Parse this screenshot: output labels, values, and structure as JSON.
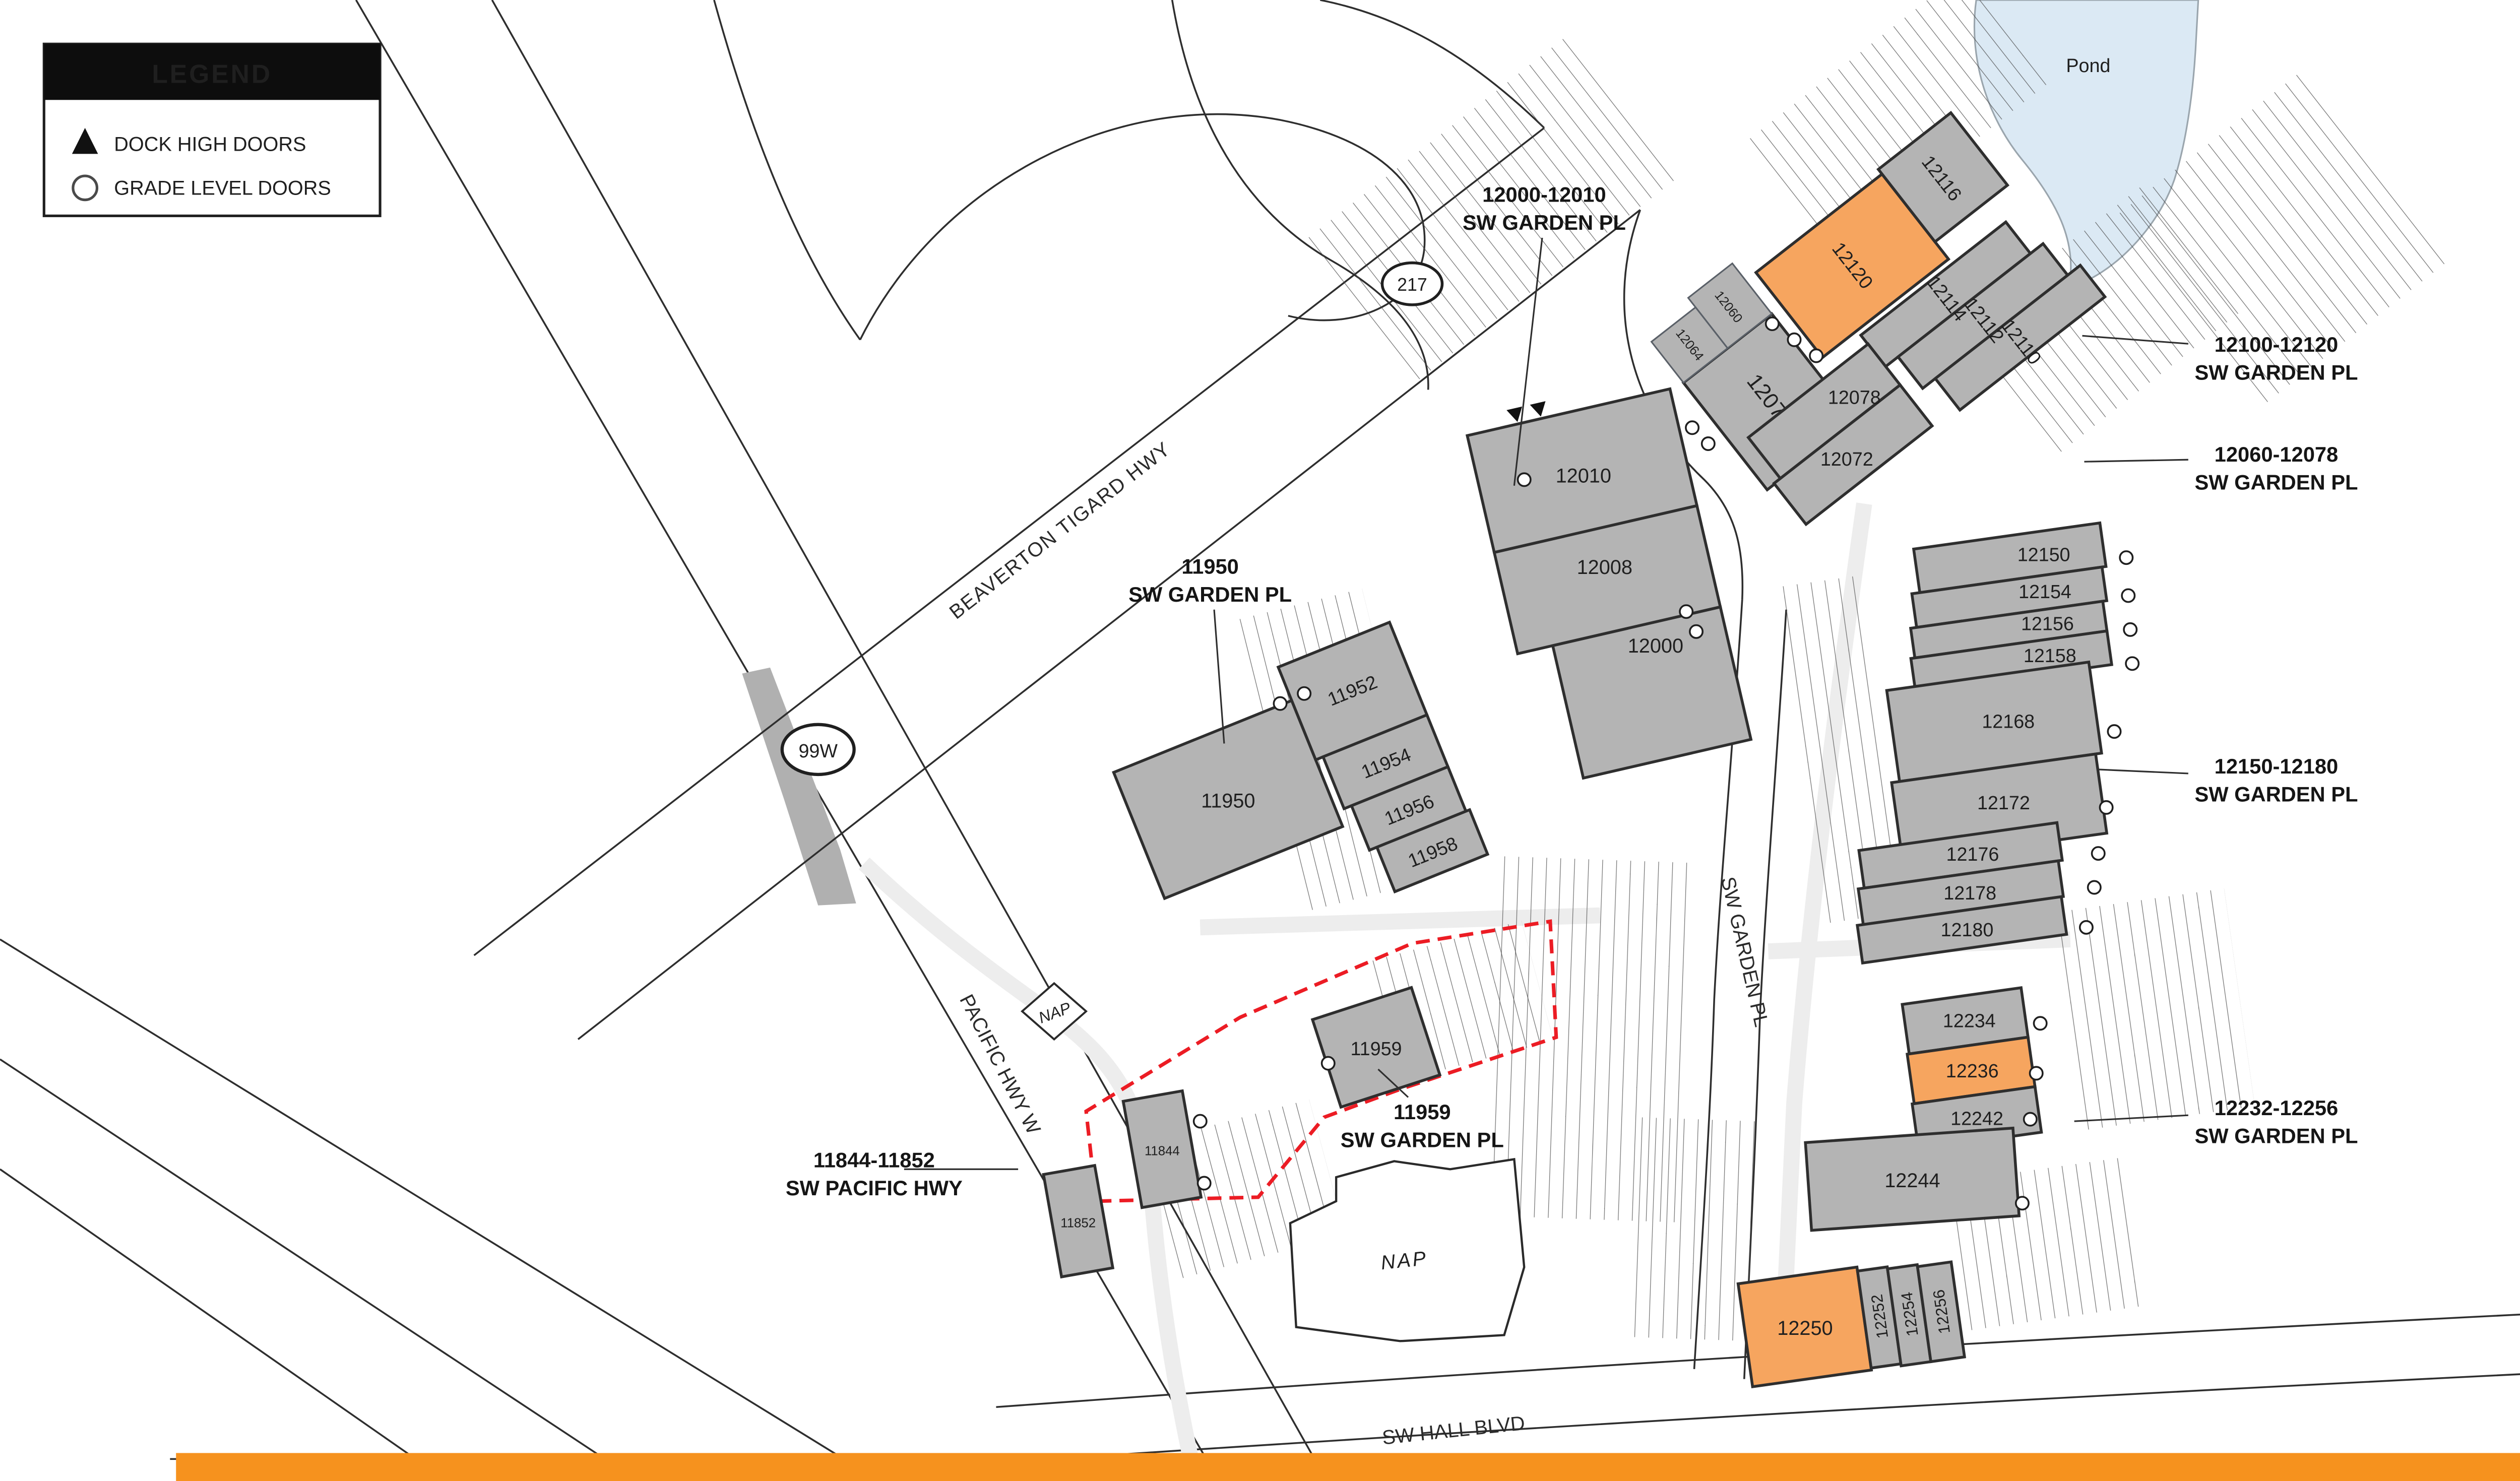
{
  "legend": {
    "title": "LEGEND",
    "items": [
      {
        "icon": "dock-high-triangle-icon",
        "label": "DOCK HIGH DOORS"
      },
      {
        "icon": "grade-level-circle-icon",
        "label": "GRADE LEVEL DOORS"
      }
    ]
  },
  "north": {
    "label": "N"
  },
  "pond": {
    "label": "Pond"
  },
  "shields": {
    "s217": "217",
    "s99w": "99W"
  },
  "streets": {
    "beaverton": "BEAVERTON TIGARD HWY",
    "pacific": "PACIFIC HWY W",
    "garden": "SW GARDEN PL",
    "hall": "SW HALL BLVD"
  },
  "nap": {
    "small": "NAP",
    "large": "NAP"
  },
  "address_labels": [
    {
      "line1": "12000-12010",
      "line2": "SW GARDEN PL"
    },
    {
      "line1": "12100-12120",
      "line2": "SW GARDEN PL"
    },
    {
      "line1": "12060-12078",
      "line2": "SW GARDEN PL"
    },
    {
      "line1": "11950",
      "line2": "SW GARDEN PL"
    },
    {
      "line1": "12150-12180",
      "line2": "SW GARDEN PL"
    },
    {
      "line1": "11959",
      "line2": "SW GARDEN PL"
    },
    {
      "line1": "11844-11852",
      "line2": "SW PACIFIC HWY"
    },
    {
      "line1": "12232-12256",
      "line2": "SW GARDEN PL"
    }
  ],
  "units": {
    "12116": "12116",
    "12120": "12120",
    "12114": "12114",
    "12112": "12112",
    "12110": "12110",
    "12060": "12060",
    "12064": "12064",
    "12070": "12070",
    "12078": "12078",
    "12072": "12072",
    "12010": "12010",
    "12008": "12008",
    "12000": "12000",
    "11950": "11950",
    "11952": "11952",
    "11954": "11954",
    "11956": "11956",
    "11958": "11958",
    "11959": "11959",
    "11844": "11844",
    "11852": "11852",
    "12150": "12150",
    "12154": "12154",
    "12156": "12156",
    "12158": "12158",
    "12168": "12168",
    "12172": "12172",
    "12176": "12176",
    "12178": "12178",
    "12180": "12180",
    "12234": "12234",
    "12236": "12236",
    "12242": "12242",
    "12244": "12244",
    "12250": "12250",
    "12252": "12252",
    "12254": "12254",
    "12256": "12256"
  },
  "highlighted_units": [
    "12120",
    "12236",
    "12250"
  ],
  "colors": {
    "building_gray": "#b4b4b4",
    "highlight_orange": "#f6a55f",
    "footer_orange": "#f6921e",
    "pond_blue": "#dbe9f4",
    "boundary_red": "#ec1c24",
    "line_dark": "#2e2e2e"
  }
}
